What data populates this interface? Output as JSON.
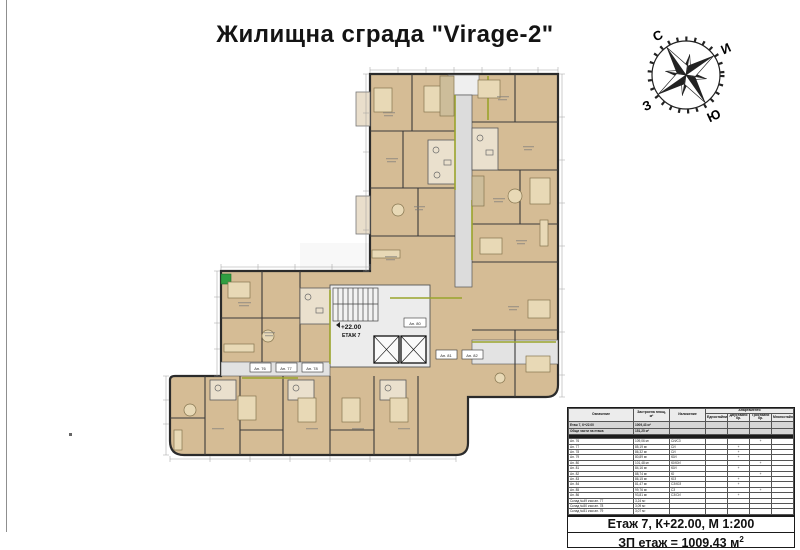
{
  "title": "Жилищна сграда \"Virage-2\"",
  "compass": {
    "north": "С",
    "east": "И",
    "west": "З",
    "south": "Ю"
  },
  "watermark": {
    "brand": "АДРЕС",
    "domain": "address.bg"
  },
  "plan": {
    "level_mark": "+22.00",
    "level_label": "ЕТАЖ 7",
    "unit_labels": [
      "Ап. 80",
      "Ап. 76",
      "Ап. 77",
      "Ап. 78",
      "Ап. 81",
      "Ап. 82"
    ]
  },
  "table": {
    "h_designation": "Означение",
    "h_area": "Застроена площ, м²",
    "h_exposure": "Изложение",
    "h_group": "Апартаменти",
    "h_sub": [
      "Едностайни",
      "Двустайни бр.",
      "Тристайни бр.",
      "Многостайни"
    ],
    "rows": [
      {
        "t": "sum",
        "c": [
          "Етаж 7, К+22.00",
          "1009,43 м²",
          "",
          "",
          "",
          "",
          ""
        ]
      },
      {
        "t": "sum",
        "c": [
          "Общи части на етажа",
          "151,25 м²",
          "",
          "",
          "",
          "",
          ""
        ]
      },
      {
        "t": "dark"
      },
      {
        "t": "",
        "c": [
          "Ап. 76",
          "109,06 м²",
          "СИ/СЗ",
          "",
          "",
          "+",
          ""
        ]
      },
      {
        "t": "",
        "c": [
          "Ап. 77",
          "85,19 м²",
          "СИ",
          "",
          "+",
          "",
          ""
        ]
      },
      {
        "t": "",
        "c": [
          "Ап. 78",
          "86,32 м²",
          "СИ",
          "",
          "+",
          "",
          ""
        ]
      },
      {
        "t": "",
        "c": [
          "Ап. 79",
          "80,89 м²",
          "ЮИ",
          "",
          "+",
          "",
          ""
        ]
      },
      {
        "t": "",
        "c": [
          "Ап. 80",
          "101,48 м²",
          "Ю/ЮИ",
          "",
          "",
          "+",
          ""
        ]
      },
      {
        "t": "",
        "c": [
          "Ап. 81",
          "84,16 м²",
          "ЮИ",
          "",
          "+",
          "",
          ""
        ]
      },
      {
        "t": "",
        "c": [
          "Ап. 82",
          "88,74 м²",
          "Ю",
          "",
          "",
          "+",
          ""
        ]
      },
      {
        "t": "",
        "c": [
          "Ап. 83",
          "86,15 м²",
          "ЮЗ",
          "",
          "+",
          "",
          ""
        ]
      },
      {
        "t": "",
        "c": [
          "Ап. 84",
          "81,47 м²",
          "СЗ/ЮЗ",
          "",
          "+",
          "",
          ""
        ]
      },
      {
        "t": "",
        "c": [
          "Ап. 85",
          "99,76 м²",
          "СЗ",
          "",
          "",
          "+",
          ""
        ]
      },
      {
        "t": "",
        "c": [
          "Ап. 86",
          "93,81 м²",
          "СЗ/СИ",
          "",
          "+",
          "",
          ""
        ]
      },
      {
        "t": "",
        "c": [
          "Склад №49 към ап. 77",
          "3,24 м²",
          "",
          "",
          "",
          "",
          ""
        ]
      },
      {
        "t": "",
        "c": [
          "Склад №50 към ап. 78",
          "3,09 м²",
          "",
          "",
          "",
          "",
          ""
        ]
      },
      {
        "t": "",
        "c": [
          "Склад №51 към ап. 79",
          "3,07 м²",
          "",
          "",
          "",
          "",
          ""
        ]
      }
    ],
    "footer_scale": "Етаж 7, К+22.00, М 1:200",
    "footer_area": "ЗП етаж = 1009.43 м",
    "footer_area_sup": "2"
  }
}
